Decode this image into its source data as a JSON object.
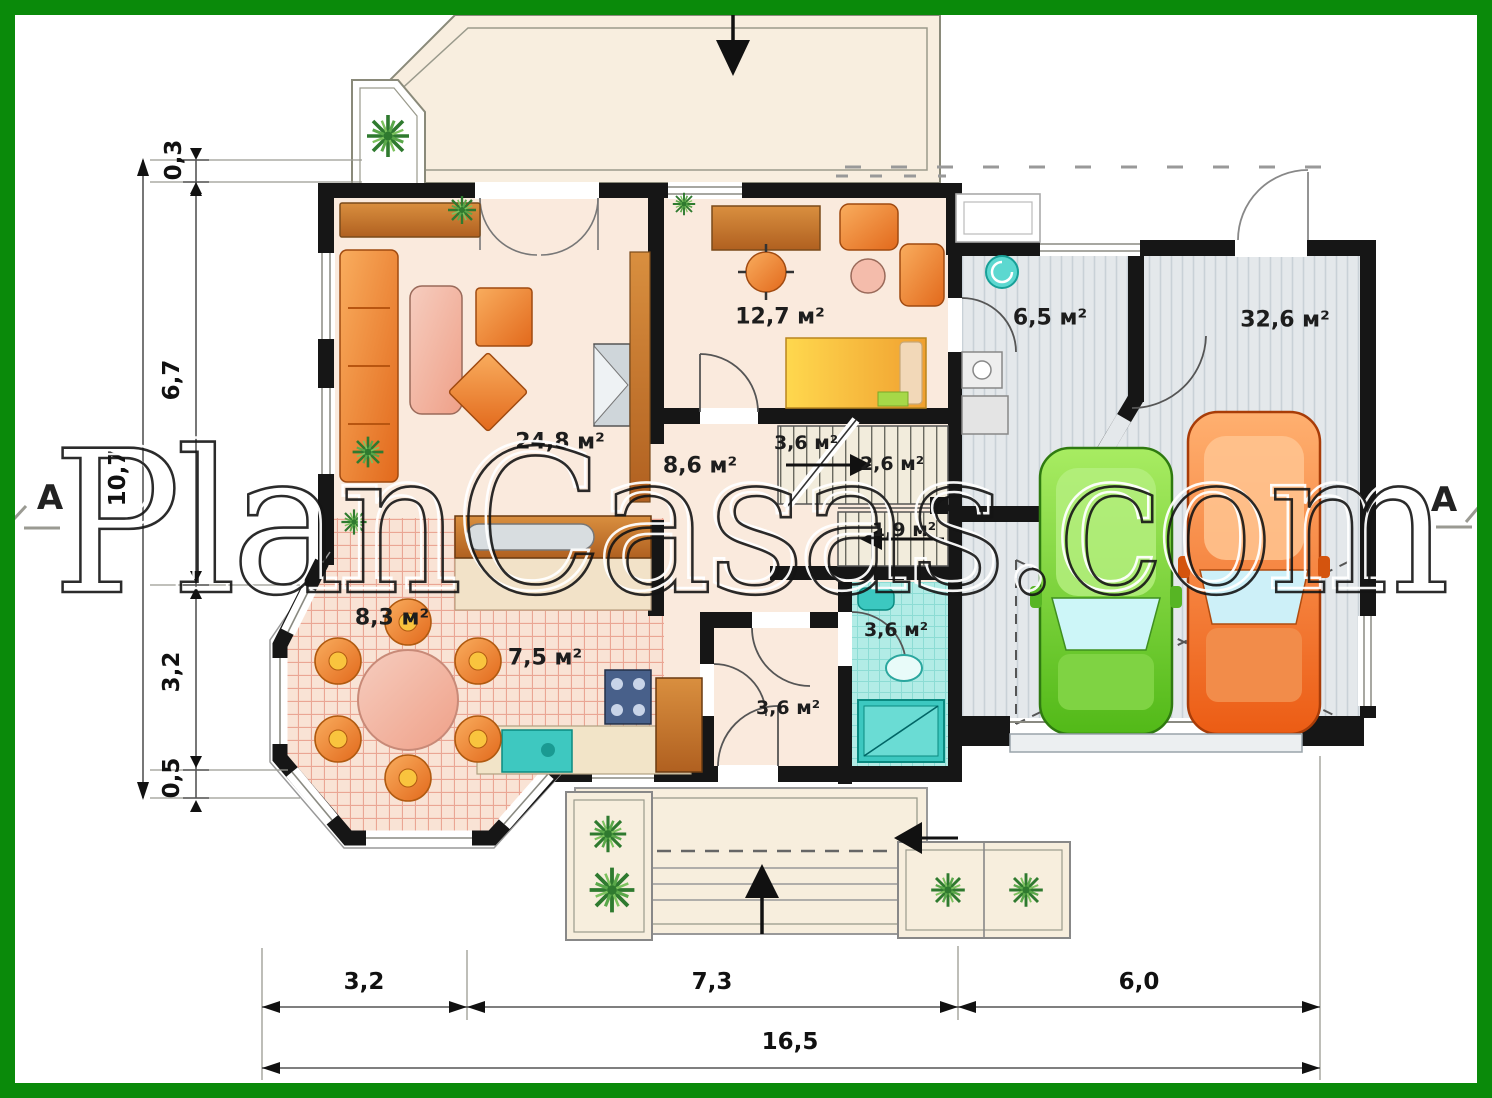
{
  "watermark": {
    "text": "PlanCasas.com"
  },
  "section_markers": {
    "left": "A",
    "right": "A"
  },
  "rooms": {
    "living": {
      "label": "24,8 м²"
    },
    "study": {
      "label": "12,7 м²"
    },
    "hall": {
      "label": "8,6 м²"
    },
    "stairs_landing": {
      "label": "3,6 м²"
    },
    "stairs_upper": {
      "label": "2,6 м²"
    },
    "stairs_lower": {
      "label": "1,9 м²"
    },
    "utility": {
      "label": "6,5 м²"
    },
    "garage": {
      "label": "32,6 м²"
    },
    "dining": {
      "label": "8,3 м²"
    },
    "kitchen": {
      "label": "7,5 м²"
    },
    "bathroom": {
      "label": "3,6 м²"
    },
    "entry": {
      "label": "3,6 м²"
    }
  },
  "dimensions": {
    "v_0_3": "0,3",
    "v_6_7": "6,7",
    "v_total": "10,7",
    "v_3_2": "3,2",
    "v_0_5": "0,5",
    "h_3_2": "3,2",
    "h_7_3": "7,3",
    "h_6_0": "6,0",
    "h_total": "16,5"
  },
  "colors": {
    "frame_green": "#0a8a0a",
    "wall_black": "#161616",
    "floor_beige": "#faeadd",
    "floor_pink_grid": "#f9e3d5",
    "garage_gray": "#e4e8eb",
    "bath_cyan": "#b2ece6",
    "furniture_orange": "#e2691c",
    "car_green": "#52b918",
    "car_orange": "#ec5c14"
  }
}
